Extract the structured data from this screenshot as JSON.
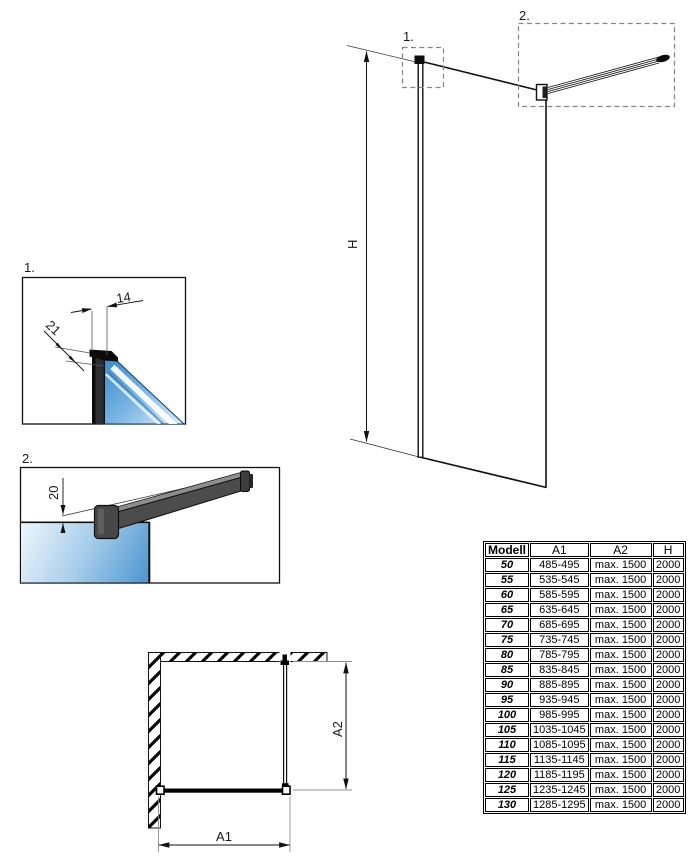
{
  "drawing": {
    "main_view": {
      "callout_1": "1.",
      "callout_2": "2.",
      "height_label": "H"
    },
    "detail_1": {
      "label": "1.",
      "dim_glass_offset": "14",
      "dim_profile_depth": "21"
    },
    "detail_2": {
      "label": "2.",
      "dim_bar_offset": "20"
    },
    "plan_view": {
      "width_label": "A1",
      "depth_label": "A2"
    }
  },
  "table": {
    "headers": [
      "Modell",
      "A1",
      "A2",
      "H"
    ],
    "rows": [
      [
        "50",
        "485-495",
        "max. 1500",
        "2000"
      ],
      [
        "55",
        "535-545",
        "max. 1500",
        "2000"
      ],
      [
        "60",
        "585-595",
        "max. 1500",
        "2000"
      ],
      [
        "65",
        "635-645",
        "max. 1500",
        "2000"
      ],
      [
        "70",
        "685-695",
        "max. 1500",
        "2000"
      ],
      [
        "75",
        "735-745",
        "max. 1500",
        "2000"
      ],
      [
        "80",
        "785-795",
        "max. 1500",
        "2000"
      ],
      [
        "85",
        "835-845",
        "max. 1500",
        "2000"
      ],
      [
        "90",
        "885-895",
        "max. 1500",
        "2000"
      ],
      [
        "95",
        "935-945",
        "max. 1500",
        "2000"
      ],
      [
        "100",
        "985-995",
        "max. 1500",
        "2000"
      ],
      [
        "105",
        "1035-1045",
        "max. 1500",
        "2000"
      ],
      [
        "110",
        "1085-1095",
        "max. 1500",
        "2000"
      ],
      [
        "115",
        "1135-1145",
        "max. 1500",
        "2000"
      ],
      [
        "120",
        "1185-1195",
        "max. 1500",
        "2000"
      ],
      [
        "125",
        "1235-1245",
        "max. 1500",
        "2000"
      ],
      [
        "130",
        "1285-1295",
        "max. 1500",
        "2000"
      ]
    ]
  },
  "colors": {
    "glass_blue": "#4a94cf",
    "glass_light": "#eef6fc",
    "profile_dark": "#2e2e2e",
    "line": "#111111"
  }
}
